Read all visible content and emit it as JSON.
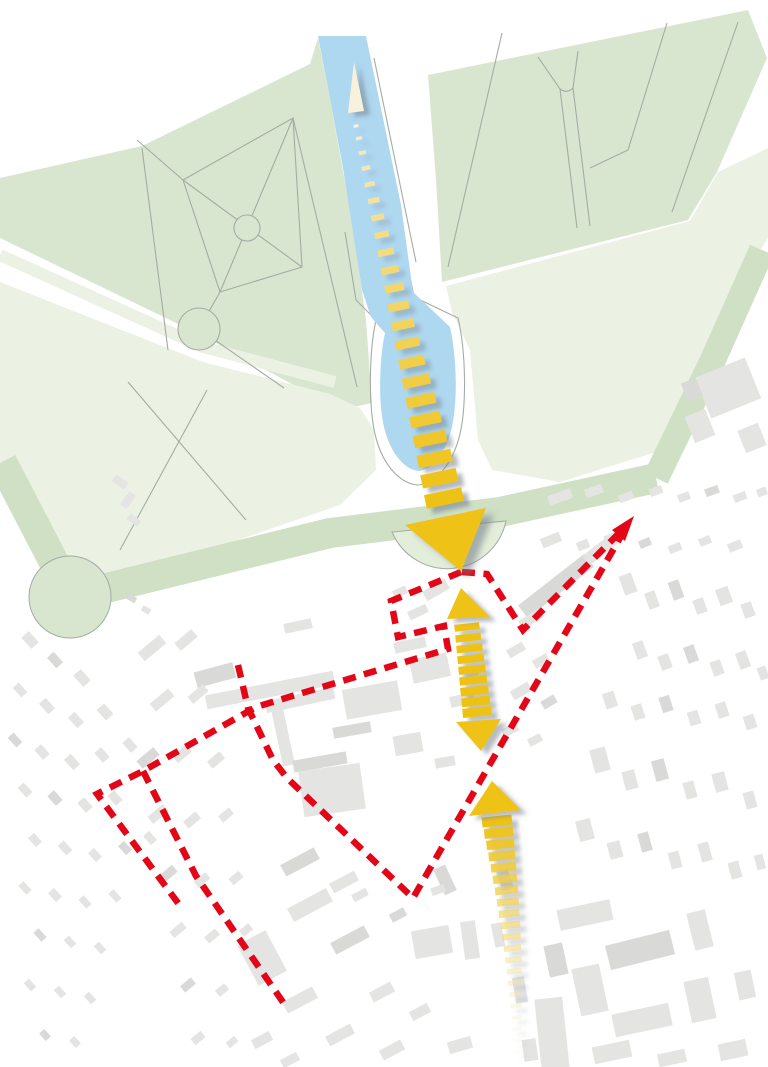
{
  "meta": {
    "description": "urban-design axis concept diagram over a site map; no visible text labels",
    "canvas": {
      "width": 768,
      "height": 1067
    }
  },
  "colors": {
    "background": "#FFFFFF",
    "park_green": "#D8E6CF",
    "park_green_light": "#EBF2E4",
    "avenue_green": "#CFE0C5",
    "semicircle_green": "#E3EEDA",
    "canal_blue": "#AED7F0",
    "path_line": "#A4ACA3",
    "building_gray": "#E4E4E3",
    "building_gray_dark": "#D9D9D8",
    "boundary_red": "#E30617",
    "axis_gold": "#EEC215",
    "axis_pale": "#F8F1DC",
    "shadow": "#76818C"
  },
  "geometry": {
    "parks": [
      {
        "name": "park-upper-left",
        "fill": "park_green",
        "points": "0,178 142,146 310,64 318,38 330,100 352,220 366,320 372,403 340,410 203,336 0,238"
      },
      {
        "name": "lawn-left",
        "fill": "park_green_light",
        "points": "0,282 203,362 330,394 360,408 374,430 376,470 340,505 200,553 80,582 30,520 0,462"
      },
      {
        "name": "park-upper-right",
        "fill": "park_green",
        "points": "428,75 748,10 767,58 717,172 688,220 442,282 436,180"
      },
      {
        "name": "lawn-right",
        "fill": "park_green_light",
        "points": "446,286 690,221 718,172 768,148 768,238 735,292 700,360 656,452 560,482 492,470 478,440 470,350 452,312"
      }
    ],
    "allee_strip": {
      "points": "0,255 203,347 335,382",
      "width": 12
    },
    "avenues": [
      {
        "name": "avenue-west",
        "points": "2,462 72,597",
        "width": 30
      },
      {
        "name": "avenue-cross",
        "points": "70,597 330,533 500,512 656,478",
        "width": 30
      },
      {
        "name": "avenue-east",
        "points": "656,478 712,362 762,250",
        "width": 26
      }
    ],
    "roundabout": {
      "cx": 70,
      "cy": 597,
      "r": 41
    },
    "semicircle": {
      "d": "M392,532 A60,60 0 0 0 506,521 Z"
    },
    "canal": {
      "d": "M318,36 L366,36 L401,205 L413,292 L450,327 C457,358 458,404 451,431 C444,457 430,470 419,471 C406,470 392,456 385,431 C378,406 379,360 385,333 L371,317 L362,290 L343,168 Z"
    },
    "canal_outlines": [
      "M362,46 L404,246 L414,297",
      "M374,58 L416,262",
      "M414,297 L458,318 C466,352 467,408 459,438 C450,470 432,484 418,485 C402,484 384,468 376,438 C368,408 369,352 376,320 L356,300 L345,232"
    ],
    "park_paths": [
      "183,180 293,118 302,267 220,292 183,180",
      "183,180 302,267",
      "293,118 220,292",
      "137,140 183,180",
      "293,118 357,387",
      "199,329 284,388",
      "220,292 199,329",
      "142,148 168,350",
      "207,390 120,550",
      "128,382 246,520",
      "502,33 448,267",
      "667,23 628,150 590,168",
      "738,22 672,212",
      "560,89 577,228",
      "573,88 590,226"
    ],
    "park_path_curves": [
      "M538,57 L560,89 Q567,94 573,88 L578,51"
    ],
    "park_circles": [
      {
        "cx": 247,
        "cy": 228,
        "r": 13
      },
      {
        "cx": 199,
        "cy": 329,
        "r": 21
      }
    ],
    "buildings": [
      [
        215,
        675,
        40,
        16,
        -15
      ],
      [
        270,
        690,
        130,
        14,
        -11
      ],
      [
        436,
        590,
        26,
        11,
        -30
      ],
      [
        300,
        700,
        70,
        12,
        -12
      ],
      [
        372,
        700,
        56,
        30,
        -10
      ],
      [
        283,
        737,
        12,
        58,
        -12
      ],
      [
        320,
        762,
        54,
        12,
        -10
      ],
      [
        430,
        668,
        38,
        24,
        -12
      ],
      [
        462,
        700,
        24,
        11,
        -12
      ],
      [
        332,
        790,
        62,
        46,
        -8
      ],
      [
        410,
        645,
        32,
        11,
        -12
      ],
      [
        298,
        626,
        28,
        10,
        -12
      ],
      [
        352,
        730,
        38,
        11,
        -10
      ],
      [
        408,
        744,
        28,
        20,
        -10
      ],
      [
        445,
        762,
        20,
        10,
        -10
      ],
      [
        470,
        672,
        16,
        9,
        -12
      ],
      [
        418,
        612,
        20,
        9,
        -25
      ],
      [
        400,
        592,
        14,
        8,
        -25
      ],
      [
        556,
        586,
        84,
        16,
        -38
      ],
      [
        601,
        549,
        38,
        12,
        -38
      ],
      [
        531,
        619,
        24,
        10,
        -32
      ],
      [
        516,
        650,
        18,
        9,
        -30
      ],
      [
        541,
        661,
        16,
        9,
        -30
      ],
      [
        521,
        691,
        20,
        10,
        -30
      ],
      [
        549,
        702,
        15,
        9,
        -30
      ],
      [
        510,
        730,
        16,
        9,
        -28
      ],
      [
        535,
        740,
        14,
        8,
        -28
      ],
      [
        728,
        388,
        54,
        44,
        -22
      ],
      [
        700,
        426,
        22,
        28,
        -22
      ],
      [
        752,
        438,
        22,
        24,
        -22
      ],
      [
        692,
        390,
        16,
        20,
        -22
      ],
      [
        560,
        497,
        24,
        10,
        -20
      ],
      [
        594,
        491,
        18,
        9,
        -20
      ],
      [
        626,
        497,
        15,
        8,
        -20
      ],
      [
        656,
        491,
        13,
        8,
        -20
      ],
      [
        684,
        497,
        12,
        8,
        -20
      ],
      [
        712,
        491,
        14,
        8,
        -20
      ],
      [
        740,
        497,
        13,
        8,
        -20
      ],
      [
        762,
        492,
        10,
        8,
        -20
      ],
      [
        551,
        540,
        20,
        10,
        -22
      ],
      [
        583,
        545,
        12,
        9,
        -22
      ],
      [
        612,
        538,
        15,
        9,
        -22
      ],
      [
        645,
        543,
        12,
        8,
        -22
      ],
      [
        675,
        548,
        13,
        8,
        -22
      ],
      [
        705,
        541,
        12,
        8,
        -22
      ],
      [
        735,
        546,
        14,
        9,
        -22
      ],
      [
        628,
        584,
        13,
        20,
        -20
      ],
      [
        652,
        600,
        11,
        17,
        -20
      ],
      [
        676,
        590,
        11,
        19,
        -20
      ],
      [
        700,
        606,
        11,
        15,
        -20
      ],
      [
        724,
        596,
        13,
        17,
        -20
      ],
      [
        748,
        610,
        11,
        15,
        -20
      ],
      [
        640,
        650,
        11,
        17,
        -20
      ],
      [
        665,
        662,
        11,
        15,
        -20
      ],
      [
        691,
        654,
        11,
        17,
        -20
      ],
      [
        717,
        668,
        11,
        15,
        -20
      ],
      [
        743,
        660,
        11,
        17,
        -20
      ],
      [
        763,
        673,
        9,
        13,
        -20
      ],
      [
        610,
        700,
        12,
        16,
        -18
      ],
      [
        638,
        712,
        11,
        15,
        -18
      ],
      [
        666,
        704,
        11,
        16,
        -18
      ],
      [
        694,
        718,
        11,
        14,
        -18
      ],
      [
        722,
        710,
        11,
        15,
        -18
      ],
      [
        750,
        722,
        11,
        14,
        -18
      ],
      [
        600,
        760,
        16,
        24,
        -15
      ],
      [
        630,
        780,
        13,
        19,
        -15
      ],
      [
        660,
        770,
        13,
        21,
        -15
      ],
      [
        690,
        790,
        11,
        17,
        -15
      ],
      [
        720,
        782,
        13,
        19,
        -15
      ],
      [
        750,
        800,
        11,
        17,
        -15
      ],
      [
        585,
        830,
        15,
        21,
        -15
      ],
      [
        615,
        850,
        13,
        17,
        -15
      ],
      [
        645,
        842,
        11,
        19,
        -15
      ],
      [
        675,
        860,
        11,
        17,
        -15
      ],
      [
        705,
        852,
        11,
        19,
        -15
      ],
      [
        735,
        870,
        11,
        17,
        -15
      ],
      [
        760,
        862,
        9,
        15,
        -15
      ],
      [
        585,
        915,
        54,
        21,
        -12
      ],
      [
        640,
        950,
        66,
        25,
        -14
      ],
      [
        700,
        930,
        19,
        38,
        -14
      ],
      [
        590,
        990,
        28,
        48,
        -12
      ],
      [
        642,
        1020,
        58,
        23,
        -12
      ],
      [
        700,
        1000,
        25,
        42,
        -12
      ],
      [
        745,
        985,
        17,
        28,
        -12
      ],
      [
        556,
        960,
        19,
        32,
        -12
      ],
      [
        612,
        1052,
        38,
        17,
        -12
      ],
      [
        672,
        1058,
        28,
        13,
        -12
      ],
      [
        733,
        1050,
        28,
        17,
        -12
      ],
      [
        552,
        1034,
        28,
        72,
        -6
      ],
      [
        470,
        940,
        15,
        38,
        -8
      ],
      [
        445,
        880,
        13,
        28,
        -25
      ],
      [
        505,
        880,
        12,
        20,
        -20
      ],
      [
        498,
        935,
        10,
        24,
        -12
      ],
      [
        520,
        990,
        12,
        26,
        -10
      ],
      [
        530,
        1050,
        14,
        22,
        -8
      ],
      [
        30,
        640,
        10,
        15,
        -42
      ],
      [
        55,
        660,
        9,
        14,
        -42
      ],
      [
        82,
        678,
        10,
        15,
        -42
      ],
      [
        20,
        690,
        8,
        13,
        -42
      ],
      [
        47,
        706,
        9,
        14,
        -42
      ],
      [
        76,
        720,
        9,
        14,
        -42
      ],
      [
        105,
        712,
        10,
        14,
        -42
      ],
      [
        15,
        740,
        8,
        13,
        -42
      ],
      [
        42,
        752,
        9,
        13,
        -42
      ],
      [
        72,
        762,
        9,
        14,
        -42
      ],
      [
        102,
        755,
        9,
        13,
        -42
      ],
      [
        130,
        745,
        9,
        13,
        -42
      ],
      [
        25,
        790,
        8,
        13,
        -42
      ],
      [
        55,
        798,
        9,
        13,
        -42
      ],
      [
        85,
        805,
        9,
        13,
        -42
      ],
      [
        115,
        798,
        9,
        13,
        -42
      ],
      [
        35,
        840,
        8,
        12,
        -42
      ],
      [
        65,
        848,
        8,
        13,
        -42
      ],
      [
        95,
        855,
        8,
        12,
        -42
      ],
      [
        125,
        848,
        8,
        12,
        -42
      ],
      [
        150,
        838,
        8,
        12,
        -42
      ],
      [
        25,
        888,
        7,
        12,
        -42
      ],
      [
        55,
        895,
        8,
        12,
        -42
      ],
      [
        85,
        902,
        7,
        12,
        -42
      ],
      [
        115,
        896,
        7,
        12,
        -42
      ],
      [
        40,
        935,
        7,
        12,
        -42
      ],
      [
        70,
        942,
        7,
        11,
        -42
      ],
      [
        100,
        948,
        7,
        11,
        -42
      ],
      [
        30,
        985,
        7,
        11,
        -42
      ],
      [
        60,
        992,
        7,
        11,
        -42
      ],
      [
        90,
        998,
        7,
        11,
        -42
      ],
      [
        45,
        1035,
        7,
        10,
        -42
      ],
      [
        75,
        1042,
        7,
        10,
        -42
      ],
      [
        152,
        648,
        28,
        11,
        -40
      ],
      [
        186,
        640,
        22,
        10,
        -40
      ],
      [
        162,
        700,
        24,
        10,
        -40
      ],
      [
        198,
        694,
        20,
        9,
        -40
      ],
      [
        148,
        758,
        22,
        10,
        -40
      ],
      [
        182,
        754,
        18,
        9,
        -40
      ],
      [
        216,
        760,
        16,
        9,
        -40
      ],
      [
        158,
        814,
        20,
        9,
        -40
      ],
      [
        192,
        820,
        16,
        9,
        -40
      ],
      [
        226,
        815,
        14,
        8,
        -40
      ],
      [
        168,
        874,
        18,
        9,
        -40
      ],
      [
        202,
        880,
        15,
        8,
        -40
      ],
      [
        236,
        878,
        13,
        8,
        -40
      ],
      [
        178,
        930,
        16,
        8,
        -40
      ],
      [
        212,
        936,
        14,
        8,
        -40
      ],
      [
        246,
        930,
        12,
        8,
        -40
      ],
      [
        188,
        985,
        14,
        8,
        -40
      ],
      [
        222,
        990,
        12,
        8,
        -40
      ],
      [
        198,
        1038,
        13,
        8,
        -40
      ],
      [
        232,
        1042,
        11,
        7,
        -40
      ],
      [
        262,
        958,
        32,
        46,
        -28
      ],
      [
        310,
        905,
        44,
        15,
        -28
      ],
      [
        350,
        940,
        38,
        13,
        -28
      ],
      [
        300,
        1000,
        34,
        13,
        -28
      ],
      [
        340,
        1035,
        28,
        11,
        -28
      ],
      [
        382,
        992,
        24,
        11,
        -28
      ],
      [
        420,
        1012,
        20,
        10,
        -28
      ],
      [
        392,
        1050,
        24,
        11,
        -28
      ],
      [
        300,
        862,
        38,
        13,
        -28
      ],
      [
        344,
        882,
        28,
        11,
        -28
      ],
      [
        432,
        942,
        38,
        28,
        -10
      ],
      [
        262,
        1040,
        20,
        10,
        -28
      ],
      [
        290,
        1060,
        18,
        9,
        -28
      ],
      [
        360,
        895,
        16,
        8,
        -28
      ],
      [
        398,
        915,
        16,
        9,
        -28
      ],
      [
        438,
        890,
        14,
        8,
        -20
      ],
      [
        460,
        1045,
        24,
        12,
        -16
      ],
      [
        120,
        482,
        15,
        8,
        36
      ],
      [
        128,
        500,
        8,
        16,
        36
      ],
      [
        134,
        520,
        13,
        7,
        36
      ],
      [
        131,
        598,
        11,
        6,
        30
      ],
      [
        146,
        610,
        9,
        6,
        30
      ]
    ],
    "boundary": {
      "dash": "13 8.5",
      "stroke_width": 6.5,
      "polylines": [
        "461,572 391,601 398,637 444,626 448,649 256,707 143,771 97,794 181,907",
        "143,771 196,876 287,1008",
        "238,665 248,708 273,760 287,778 413,898 628,524",
        "462,572 487,574 523,630 628,524"
      ],
      "apex_arrowhead": "634,516 612,530 625,541"
    },
    "axis": {
      "pale_north_arrow": "354,62 348,113 364,111",
      "triangles": {
        "main_down": "461,571 405,525 486,508",
        "mid_up": "461,588 447,619 490,617",
        "mid_down": "481,751 456,722 501,719",
        "low_up": "492,781 469,816 521,810"
      },
      "dash_runs": [
        {
          "name": "canal-axis-dashes",
          "x1": 356,
          "y1": 126,
          "x2": 444,
          "y2": 498,
          "n": 22,
          "w": [
            5,
            38
          ],
          "h": [
            3,
            14
          ],
          "ang": -12,
          "ease": 1.12,
          "c": [
            "axis_pale",
            "axis_gold"
          ],
          "cPow": 0.7,
          "sh": [
            0.15,
            0.58
          ]
        },
        {
          "name": "town-link-dashes",
          "x1": 467,
          "y1": 627,
          "x2": 477,
          "y2": 712,
          "n": 9,
          "w": [
            25,
            29
          ],
          "h": [
            7,
            9
          ],
          "ang": -6,
          "c": [
            "axis_gold",
            "axis_gold"
          ],
          "sh": [
            0.5,
            0.5
          ]
        },
        {
          "name": "south-trail-dashes",
          "x1": 497,
          "y1": 821,
          "x2": 518,
          "y2": 1052,
          "n": 21,
          "w": [
            30,
            7
          ],
          "h": [
            10,
            3
          ],
          "ang": -6,
          "bow": 4,
          "c": [
            "axis_gold",
            "axis_pale"
          ],
          "cPow": 1.2,
          "fade": [
            1,
            0.12
          ],
          "sh": [
            0.5,
            0.06
          ]
        }
      ]
    }
  }
}
